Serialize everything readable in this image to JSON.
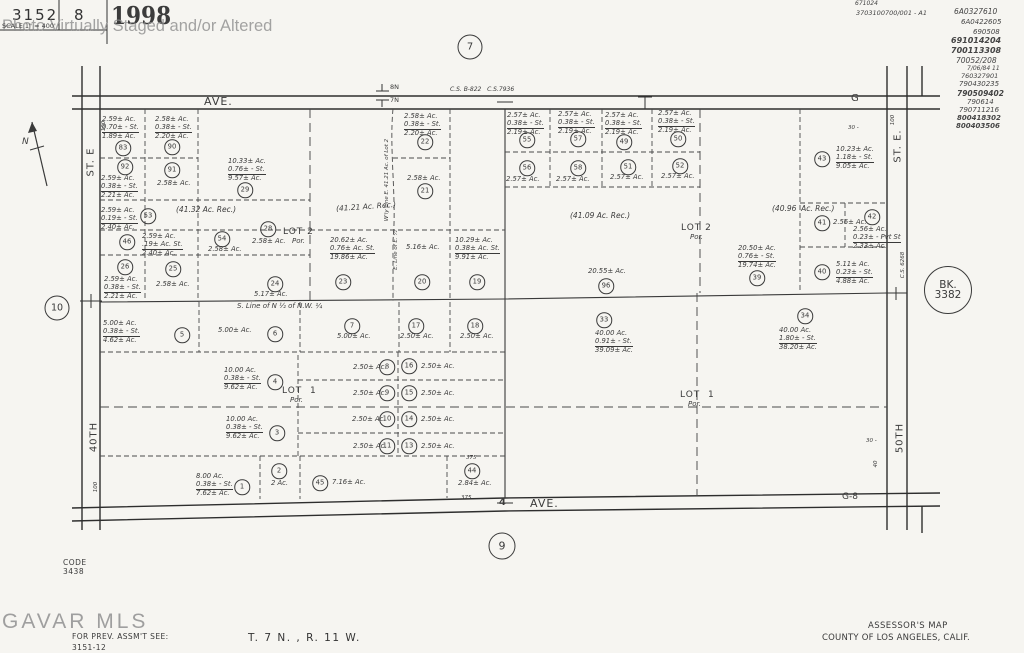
{
  "header": {
    "book": "3152",
    "page_no": "8",
    "year": "1998",
    "scale": "SCALE 1\" = 400'",
    "watermark": "Photo Virtually Staged and/or Altered"
  },
  "footer": {
    "gavar": "GAVAR MLS",
    "code_label": "CODE",
    "code": "3438",
    "prev_assmt": "FOR PREV. ASSM'T SEE:",
    "prev_assmt_ref": "3151-12",
    "township": "T. 7 N. , R. 11 W.",
    "map_title": "ASSESSOR'S MAP",
    "county": "COUNTY OF LOS ANGELES, CALIF."
  },
  "records": [
    {
      "t": "671024",
      "x": 855,
      "y": 1,
      "s": 6
    },
    {
      "t": "3703100700/001 - A1",
      "x": 856,
      "y": 10,
      "s": 6.5
    },
    {
      "t": "6A0327610",
      "x": 954,
      "y": 8,
      "s": 7.5
    },
    {
      "t": "6A0422605",
      "x": 961,
      "y": 19,
      "s": 7
    },
    {
      "t": "690508",
      "x": 973,
      "y": 29,
      "s": 7
    },
    {
      "t": "691014204",
      "x": 951,
      "y": 37,
      "s": 8,
      "w": 600
    },
    {
      "t": "700113308",
      "x": 951,
      "y": 47,
      "s": 8,
      "w": 600
    },
    {
      "t": "70052/208",
      "x": 956,
      "y": 57,
      "s": 7.5
    },
    {
      "t": "7/06/84 11",
      "x": 967,
      "y": 66,
      "s": 6
    },
    {
      "t": "760327901",
      "x": 961,
      "y": 73,
      "s": 6.5
    },
    {
      "t": "790430235",
      "x": 959,
      "y": 81,
      "s": 7
    },
    {
      "t": "790509402",
      "x": 957,
      "y": 90,
      "s": 7.5,
      "w": 600
    },
    {
      "t": "790614",
      "x": 967,
      "y": 99,
      "s": 7
    },
    {
      "t": "790711216",
      "x": 959,
      "y": 107,
      "s": 7
    },
    {
      "t": "800418302",
      "x": 957,
      "y": 115,
      "s": 7,
      "w": 700
    },
    {
      "t": "800403506",
      "x": 956,
      "y": 123,
      "s": 7,
      "w": 700
    }
  ],
  "reference_circles": [
    {
      "n": "section-ref-7",
      "t": "7",
      "x": 470,
      "y": 47,
      "d": 23,
      "s": 10
    },
    {
      "n": "section-ref-9",
      "t": "9",
      "x": 502,
      "y": 546,
      "d": 25,
      "s": 11
    },
    {
      "n": "section-ref-10",
      "t": "10",
      "x": 57,
      "y": 308,
      "d": 23,
      "s": 9.5
    },
    {
      "n": "book-ref-3382",
      "lines": [
        "BK.",
        "3382"
      ],
      "x": 948,
      "y": 290,
      "d": 46,
      "s": 10.5
    }
  ],
  "labels": [
    {
      "n": "ave-top-label",
      "t": "AVE.",
      "x": 204,
      "y": 96,
      "s": 11,
      "ls": 1
    },
    {
      "n": "cs-ref-top",
      "t": "C.S. B-822   C.S.7936",
      "x": 450,
      "y": 87,
      "s": 6,
      "it": 1
    },
    {
      "n": "township-8n",
      "t": "8N",
      "x": 390,
      "y": 84,
      "s": 6.5
    },
    {
      "n": "township-7n",
      "t": "7N",
      "x": 390,
      "y": 97,
      "s": 6.5
    },
    {
      "n": "g-road-label",
      "t": "G",
      "x": 851,
      "y": 93,
      "s": 10
    },
    {
      "n": "ave-bottom-label",
      "t": "AVE.",
      "x": 530,
      "y": 498,
      "s": 11,
      "ls": 1
    },
    {
      "n": "section-corner-4",
      "t": "4",
      "x": 499,
      "y": 497,
      "s": 10,
      "w": 600
    },
    {
      "n": "g8-road-label",
      "t": "G-8",
      "x": 842,
      "y": 493,
      "s": 9
    },
    {
      "n": "st-e-left-label",
      "t": "ST. E",
      "x": 91,
      "y": 162,
      "s": 10,
      "rot": -90,
      "ls": 1
    },
    {
      "n": "st-40th-label",
      "t": "40TH",
      "x": 94,
      "y": 437,
      "s": 10,
      "rot": -90,
      "ls": 1
    },
    {
      "n": "st-e-right-label",
      "t": "ST. E.",
      "x": 898,
      "y": 146,
      "s": 10,
      "rot": -90,
      "ls": 1
    },
    {
      "n": "st-50th-label",
      "t": "50TH",
      "x": 900,
      "y": 438,
      "s": 10,
      "rot": -90,
      "ls": 1
    },
    {
      "n": "cs-6268-label",
      "t": "C.S. 6268",
      "x": 903,
      "y": 265,
      "s": 5.5,
      "rot": -90,
      "it": 1
    },
    {
      "n": "lot2-left-label",
      "t": "LOT 2",
      "x": 283,
      "y": 228,
      "s": 9,
      "ls": 1
    },
    {
      "n": "lot2-left-por",
      "t": "Por.",
      "x": 292,
      "y": 238,
      "s": 7,
      "it": 1
    },
    {
      "n": "lot2-right-label",
      "t": "LOT 2",
      "x": 681,
      "y": 224,
      "s": 9,
      "ls": 1
    },
    {
      "n": "lot2-right-por",
      "t": "Por.",
      "x": 690,
      "y": 234,
      "s": 7,
      "it": 1
    },
    {
      "n": "lot1-left-label",
      "t": "LOT  1",
      "x": 282,
      "y": 387,
      "s": 9,
      "ls": 1
    },
    {
      "n": "lot1-left-por",
      "t": "Por.",
      "x": 290,
      "y": 397,
      "s": 7,
      "it": 1
    },
    {
      "n": "lot1-right-label",
      "t": "LOT  1",
      "x": 680,
      "y": 391,
      "s": 9,
      "ls": 1
    },
    {
      "n": "lot1-right-por",
      "t": "Por.",
      "x": 688,
      "y": 401,
      "s": 7,
      "it": 1
    },
    {
      "n": "area-rec-4132",
      "t": "(41.32 Ac. Rec.)",
      "x": 176,
      "y": 206,
      "s": 7.5,
      "it": 1
    },
    {
      "n": "area-rec-4121",
      "t": "(41.21 Ac. Rec.)",
      "x": 336,
      "y": 203,
      "s": 7.5,
      "it": 1,
      "rot2": -4
    },
    {
      "n": "area-rec-4109",
      "t": "(41.09 Ac. Rec.)",
      "x": 570,
      "y": 212,
      "s": 7.5,
      "it": 1
    },
    {
      "n": "area-rec-4096",
      "t": "(40.96  Ac. Rec.)",
      "x": 772,
      "y": 205,
      "s": 7.5,
      "it": 1
    },
    {
      "n": "s-line-nw-quarter",
      "t": "S. Line of N ½ of N.W. ¼",
      "x": 237,
      "y": 303,
      "s": 7,
      "it": 1
    },
    {
      "n": "w-line-note",
      "t": "W'ly Line E. 41.21 Ac. of Lot 2",
      "x": 387,
      "y": 180,
      "s": 5.5,
      "rot": -90,
      "it": 1
    },
    {
      "n": "e-line-note",
      "t": "E. Line of E. ½",
      "x": 396,
      "y": 250,
      "s": 5.5,
      "rot": -90,
      "it": 1
    },
    {
      "n": "dim-375-top",
      "t": "375",
      "x": 466,
      "y": 455,
      "s": 5.5,
      "it": 1
    },
    {
      "n": "dim-375-bottom",
      "t": "375",
      "x": 461,
      "y": 495,
      "s": 5.5,
      "it": 1
    },
    {
      "n": "dim-100-top-left",
      "t": "100",
      "x": 104,
      "y": 126,
      "s": 5.5,
      "it": 1,
      "rot": -90
    },
    {
      "n": "dim-100-bottom-left",
      "t": "100",
      "x": 96,
      "y": 487,
      "s": 5.5,
      "it": 1,
      "rot": -90
    },
    {
      "n": "dim-100-top-right",
      "t": "100",
      "x": 893,
      "y": 120,
      "s": 5.5,
      "it": 1,
      "rot": -90
    },
    {
      "n": "dim-30-top-right",
      "t": "30 -",
      "x": 848,
      "y": 125,
      "s": 5.5,
      "it": 1
    },
    {
      "n": "dim-30-bottom-right",
      "t": "30 -",
      "x": 866,
      "y": 438,
      "s": 5.5,
      "it": 1
    },
    {
      "n": "dim-40-bottom-right",
      "t": "40",
      "x": 876,
      "y": 464,
      "s": 5.5,
      "it": 1,
      "rot": -90
    },
    {
      "n": "north-letter",
      "t": "N",
      "x": 22,
      "y": 138,
      "s": 9,
      "it": 1
    }
  ],
  "parcels": [
    {
      "n": "83",
      "cx": 123,
      "cy": 148,
      "bx": 102,
      "by": 116,
      "ln": [
        "2.59± Ac.",
        "0.70± - St.",
        "1.89± Ac."
      ]
    },
    {
      "n": "90",
      "cx": 172,
      "cy": 147,
      "bx": 155,
      "by": 116,
      "ln": [
        "2.58± Ac.",
        "0.38± - St.",
        "2.20± Ac."
      ]
    },
    {
      "n": "92",
      "cx": 125,
      "cy": 167,
      "bx": 101,
      "by": 175,
      "ln": [
        "2.59± Ac.",
        "0.38± - St.",
        "2.21± Ac."
      ]
    },
    {
      "n": "91",
      "cx": 172,
      "cy": 170,
      "bx": 157,
      "by": 180,
      "ln": [
        "2.58± Ac."
      ]
    },
    {
      "n": "29",
      "cx": 245,
      "cy": 190,
      "bx": 228,
      "by": 158,
      "ln": [
        "10.33± Ac.",
        "0.76± - St.",
        "9.57± Ac."
      ]
    },
    {
      "n": "53",
      "cx": 148,
      "cy": 216,
      "bx": 101,
      "by": 207,
      "ln": [
        "2.59± Ac.",
        "0.19± - St.",
        "2.40± Ac."
      ]
    },
    {
      "n": "46",
      "cx": 127,
      "cy": 242,
      "bx": 142,
      "by": 233,
      "ln": [
        "2.59± Ac.",
        ".19± Ac. St.",
        "2.40± Ac."
      ]
    },
    {
      "n": "54",
      "cx": 222,
      "cy": 239,
      "bx": 208,
      "by": 246,
      "ln": [
        "2.58± Ac."
      ]
    },
    {
      "n": "28",
      "cx": 268,
      "cy": 229,
      "bx": 252,
      "by": 238,
      "ln": [
        "2.58± Ac."
      ]
    },
    {
      "n": "26",
      "cx": 125,
      "cy": 267,
      "bx": 104,
      "by": 276,
      "ln": [
        "2.59± Ac.",
        "0.38± - St.",
        "2.21± Ac."
      ]
    },
    {
      "n": "25",
      "cx": 173,
      "cy": 269,
      "bx": 156,
      "by": 281,
      "ln": [
        "2.58± Ac."
      ]
    },
    {
      "n": "24",
      "cx": 275,
      "cy": 284,
      "bx": 254,
      "by": 291,
      "ln": [
        "5.17± Ac."
      ]
    },
    {
      "n": "22",
      "cx": 425,
      "cy": 142,
      "bx": 404,
      "by": 113,
      "ln": [
        "2.58± Ac.",
        "0.38± - St.",
        "2.20± Ac."
      ]
    },
    {
      "n": "21",
      "cx": 425,
      "cy": 191,
      "bx": 407,
      "by": 175,
      "ln": [
        "2.58± Ac."
      ]
    },
    {
      "n": "23",
      "cx": 343,
      "cy": 282,
      "bx": 330,
      "by": 237,
      "ln": [
        "20.62± Ac.",
        "0.76± Ac. St.",
        "19.86± Ac."
      ]
    },
    {
      "n": "20",
      "cx": 422,
      "cy": 282,
      "bx": 406,
      "by": 244,
      "ln": [
        "5.16± Ac."
      ]
    },
    {
      "n": "19",
      "cx": 477,
      "cy": 282,
      "bx": 455,
      "by": 237,
      "ln": [
        "10.29± Ac.",
        "0.38± Ac. St.",
        "9.91± Ac."
      ]
    },
    {
      "n": "55",
      "cx": 527,
      "cy": 140,
      "bx": 507,
      "by": 112,
      "ln": [
        "2.57± Ac.",
        "0.38± - St.",
        "2.19± Ac."
      ]
    },
    {
      "n": "57",
      "cx": 578,
      "cy": 139,
      "bx": 558,
      "by": 111,
      "ln": [
        "2.57± Ac.",
        "0.38± - St.",
        "2.19± Ac."
      ]
    },
    {
      "n": "49",
      "cx": 624,
      "cy": 142,
      "bx": 605,
      "by": 112,
      "ln": [
        "2.57± Ac.",
        "0.38± - St.",
        "2.19± Ac."
      ]
    },
    {
      "n": "50",
      "cx": 678,
      "cy": 139,
      "bx": 658,
      "by": 110,
      "ln": [
        "2.57± Ac.",
        "0.38± - St.",
        "2.19± Ac."
      ]
    },
    {
      "n": "56",
      "cx": 527,
      "cy": 168,
      "bx": 506,
      "by": 176,
      "ln": [
        "2.57± Ac."
      ]
    },
    {
      "n": "58",
      "cx": 578,
      "cy": 168,
      "bx": 556,
      "by": 176,
      "ln": [
        "2.57± Ac."
      ]
    },
    {
      "n": "51",
      "cx": 628,
      "cy": 167,
      "bx": 610,
      "by": 174,
      "ln": [
        "2.57± Ac."
      ]
    },
    {
      "n": "52",
      "cx": 680,
      "cy": 166,
      "bx": 661,
      "by": 173,
      "ln": [
        "2.57± Ac."
      ]
    },
    {
      "n": "96",
      "cx": 606,
      "cy": 286,
      "bx": 588,
      "by": 268,
      "ln": [
        "20.55± Ac."
      ]
    },
    {
      "n": "39",
      "cx": 757,
      "cy": 278,
      "bx": 738,
      "by": 245,
      "ln": [
        "20.50± Ac.",
        "0.76± - St.",
        "19.74± Ac."
      ]
    },
    {
      "n": "43",
      "cx": 822,
      "cy": 159,
      "bx": 836,
      "by": 146,
      "ln": [
        "10.23± Ac.",
        "1.18± - St.",
        "9.05± Ac."
      ]
    },
    {
      "n": "41",
      "cx": 822,
      "cy": 223,
      "bx": 833,
      "by": 219,
      "ln": [
        "2.56± Ac."
      ]
    },
    {
      "n": "42",
      "cx": 872,
      "cy": 217,
      "bx": 853,
      "by": 226,
      "ln": [
        "2.56± Ac.",
        "0.23± - Pvt St",
        "2.33± Ac."
      ]
    },
    {
      "n": "40",
      "cx": 822,
      "cy": 272,
      "bx": 836,
      "by": 261,
      "ln": [
        "5.11± Ac.",
        "0.23± - St.",
        "4.88± Ac."
      ]
    },
    {
      "n": "5",
      "cx": 182,
      "cy": 335,
      "bx": 103,
      "by": 320,
      "ln": [
        "5.00± Ac.",
        "0.38± - St.",
        "4.62± Ac."
      ]
    },
    {
      "n": "6",
      "cx": 275,
      "cy": 334,
      "bx": 218,
      "by": 327,
      "ln": [
        "5.00± Ac."
      ]
    },
    {
      "n": "7",
      "cx": 352,
      "cy": 326,
      "bx": 337,
      "by": 333,
      "ln": [
        "5.00± Ac."
      ]
    },
    {
      "n": "17",
      "cx": 416,
      "cy": 326,
      "bx": 400,
      "by": 333,
      "ln": [
        "2.50± Ac."
      ]
    },
    {
      "n": "18",
      "cx": 475,
      "cy": 326,
      "bx": 460,
      "by": 333,
      "ln": [
        "2.50± Ac."
      ]
    },
    {
      "n": "33",
      "cx": 604,
      "cy": 320,
      "bx": 595,
      "by": 330,
      "ln": [
        "40.00 Ac.",
        "0.91± - St.",
        "39.09± Ac."
      ]
    },
    {
      "n": "34",
      "cx": 805,
      "cy": 316,
      "bx": 779,
      "by": 327,
      "ln": [
        "40.00 Ac.",
        "1.80± - St.",
        "38.20± Ac."
      ]
    },
    {
      "n": "4",
      "cx": 275,
      "cy": 382,
      "bx": 224,
      "by": 367,
      "ln": [
        "10.00 Ac.",
        "0.38± - St.",
        "9.62± Ac."
      ]
    },
    {
      "n": "8",
      "cx": 387,
      "cy": 367,
      "bx": 353,
      "by": 364,
      "ln": [
        "2.50± Ac."
      ]
    },
    {
      "n": "16",
      "cx": 409,
      "cy": 366,
      "bx": 421,
      "by": 363,
      "ln": [
        "2.50± Ac."
      ]
    },
    {
      "n": "9",
      "cx": 387,
      "cy": 393,
      "bx": 353,
      "by": 390,
      "ln": [
        "2.50± Ac."
      ]
    },
    {
      "n": "15",
      "cx": 409,
      "cy": 393,
      "bx": 421,
      "by": 390,
      "ln": [
        "2.50± Ac."
      ]
    },
    {
      "n": "10",
      "cx": 387,
      "cy": 419,
      "bx": 352,
      "by": 416,
      "ln": [
        "2.50± Ac."
      ]
    },
    {
      "n": "14",
      "cx": 409,
      "cy": 419,
      "bx": 421,
      "by": 416,
      "ln": [
        "2.50± Ac."
      ]
    },
    {
      "n": "3",
      "cx": 277,
      "cy": 433,
      "bx": 226,
      "by": 416,
      "ln": [
        "10.00 Ac.",
        "0.38± - St.",
        "9.62± Ac."
      ]
    },
    {
      "n": "11",
      "cx": 387,
      "cy": 446,
      "bx": 353,
      "by": 443,
      "ln": [
        "2.50± Ac."
      ]
    },
    {
      "n": "13",
      "cx": 409,
      "cy": 446,
      "bx": 421,
      "by": 443,
      "ln": [
        "2.50± Ac."
      ]
    },
    {
      "n": "1",
      "cx": 242,
      "cy": 487,
      "bx": 196,
      "by": 473,
      "ln": [
        "8.00 Ac.",
        "0.38± - St.",
        "7.62± Ac."
      ]
    },
    {
      "n": "2",
      "cx": 279,
      "cy": 471,
      "bx": 271,
      "by": 480,
      "ln": [
        "2 Ac."
      ]
    },
    {
      "n": "45",
      "cx": 320,
      "cy": 483,
      "bx": 332,
      "by": 479,
      "ln": [
        "7.16± Ac."
      ]
    },
    {
      "n": "44",
      "cx": 472,
      "cy": 471,
      "bx": 458,
      "by": 480,
      "ln": [
        "2.84± Ac."
      ]
    }
  ]
}
